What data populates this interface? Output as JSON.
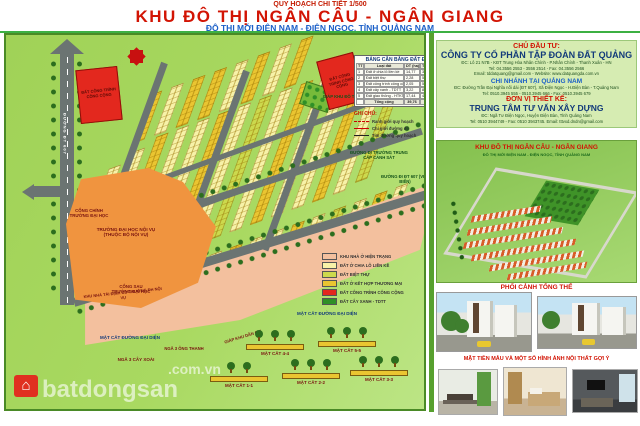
{
  "header": {
    "kicker": "QUY HOẠCH CHI TIẾT 1/500",
    "title": "KHU ĐÔ THỊ NGÂN CÂU - NGÂN GIANG",
    "subtitle": "ĐÔ THỊ MỚI ĐIỆN NAM - ĐIỆN NGỌC, TỈNH QUẢNG NAM"
  },
  "map": {
    "balance_table": {
      "title": "BẢNG CÂN BẰNG ĐẤT ĐAI",
      "headers": [
        "TT",
        "Loại đất",
        "DT (ha)",
        "Tỷ lệ (%)"
      ],
      "rows": [
        [
          "1",
          "Đất ở chia lô liền kề",
          "14,77",
          "37,2"
        ],
        [
          "2",
          "Đất biệt thự",
          "2,28",
          "5,7"
        ],
        [
          "3",
          "Đất công trình công cộng",
          "2,05",
          "5,2"
        ],
        [
          "4",
          "Đất cây xanh - TDTT",
          "3,22",
          "8,1"
        ],
        [
          "5",
          "Đất giao thông - HTKT",
          "17,44",
          "43,8"
        ],
        [
          "",
          "Tổng cộng",
          "39,76",
          "100"
        ]
      ]
    },
    "ghi_chu": {
      "title": "GHI CHÚ:",
      "items": [
        "Ranh giới quy hoạch",
        "Chỉ giới đường đỏ",
        "Tim đường quy hoạch"
      ]
    },
    "color_legend": [
      {
        "color": "#f3c09e",
        "label": "KHU NHÀ Ở HIỆN TRẠNG"
      },
      {
        "color": "#f7f2a8",
        "label": "ĐẤT Ở CHIA LÔ LIỀN KỀ"
      },
      {
        "color": "#ccd94d",
        "label": "ĐẤT BIỆT THỰ"
      },
      {
        "color": "#eac531",
        "label": "ĐẤT Ở KẾT HỢP THƯƠNG MẠI"
      },
      {
        "color": "#e3281e",
        "label": "ĐẤT CÔNG TRÌNH CÔNG CỘNG"
      },
      {
        "color": "#2f8f27",
        "label": "ĐẤT CÂY XANH - TDTT"
      }
    ],
    "sections": {
      "title": "MẶT CẮT ĐƯỜNG ĐẠI DIỆN",
      "items": [
        {
          "label": "MẶT CẮT 4-4"
        },
        {
          "label": "MẶT CẮT 5-5"
        },
        {
          "label": "MẶT CẮT 1-1"
        },
        {
          "label": "MẶT CẮT 2-2"
        },
        {
          "label": "MẶT CẮT 3-3"
        }
      ]
    },
    "labels": {
      "gate_main": "CỔNG CHÍNH\nTRƯỜNG ĐẠI HỌC",
      "university": "TRƯỜNG ĐẠI HỌC NỘI VỤ\n(THUỘC BỘ NỘI VỤ)",
      "gate_back": "CỔNG SAU\nTRƯỜNG ĐẠI HỌC",
      "tdc": "KHU NHÀ TÁI ĐỊNH CƯ TRƯỜNG ĐH NỘI VỤ",
      "nga3_xoai": "NGÃ 3 CÂY XOÀI",
      "nga3_thanh": "NGÃ 3 ÔNG THANH",
      "giap_kdc": "GIÁP KHU DÂN CƯ",
      "giap_kdt": "GIÁP KHU ĐÔ THỊ SỐ 9",
      "road_vertical": "ĐƯỜNG ĐT 607",
      "road_main": "ĐƯỜNG 27M",
      "dir_school": "ĐƯỜNG ĐI TRƯỜNG TRUNG CẤP CẢNH SÁT",
      "dir_dt607": "ĐƯỜNG ĐI ĐT 607 (VEN BIỂN)",
      "red_parcel_1": "ĐẤT CÔNG TRÌNH CÔNG CỘNG",
      "red_parcel_2": "ĐẤT CÔNG TRÌNH CÔNG CỘNG"
    }
  },
  "sidebar": {
    "investor": {
      "header": "CHỦ ĐẦU TƯ:",
      "name": "CÔNG TY CỔ PHẦN TẬP ĐOÀN ĐẤT QUẢNG",
      "addr": "ĐC: Lô 21 N7B - KĐT Trung Hòa Nhân Chính - P.Nhân Chính - Thanh Xuân - HN",
      "tel": "Tel: 04.3556 2553 - 3556 2514 - Fax: 04.3556 2566",
      "email": "Email: tddatquang@gmail.com - Website: www.datquangda.com.vn",
      "branch_header": "CHI NHÁNH TẠI QUẢNG NAM",
      "branch_addr": "ĐC: Đường Trần Đại Nghĩa nối dài (ĐT 607), Xã Điện Ngọc - H.Điện Bàn - T.Quảng Nam",
      "branch_tel": "Tel: 0510.3945 555 - 0510.3945 666 - Fax: 0510.3945 679",
      "designer_header": "ĐƠN VỊ THIẾT KẾ:",
      "designer_name": "TRUNG TÂM TƯ VẤN XÂY DỰNG",
      "designer_addr": "ĐC: Ngã Tư Điện Ngọc, Huyện Điện Bàn, Tỉnh Quảng Nam",
      "designer_tel": "Tel: 0510 3944749 - Fax: 0510 3943745. Email: tttvxd.dndn@gmail.com"
    },
    "perspective": {
      "title": "KHU ĐÔ THỊ NGÂN CÂU - NGÂN GIANG",
      "subtitle": "ĐÔ THỊ MỚI ĐIỆN NAM - ĐIỆN NGỌC, TỈNH QUẢNG NAM",
      "caption": "PHỐI CẢNH TỔNG THỂ"
    },
    "facades": {
      "caption": "MẶT TIỀN MẪU VÀ MỘT SỐ HÌNH ẢNH NỘI THẤT GỢI Ý"
    }
  },
  "watermark": {
    "brand": "batdongsan",
    "domain": ".com.vn"
  },
  "colors": {
    "title_red": "#d21404",
    "subtitle_blue": "#1a5fc8",
    "map_bg": "#a6d65f",
    "lot_yellow": "#f7f2a8",
    "lot_gold": "#eac531",
    "lot_olive": "#ccd94d",
    "university_orange": "#f0943f",
    "existing_pink": "#f3c09e",
    "public_red": "#e3281e",
    "road_gray": "#6b7472",
    "park_green": "#2f8f27"
  }
}
